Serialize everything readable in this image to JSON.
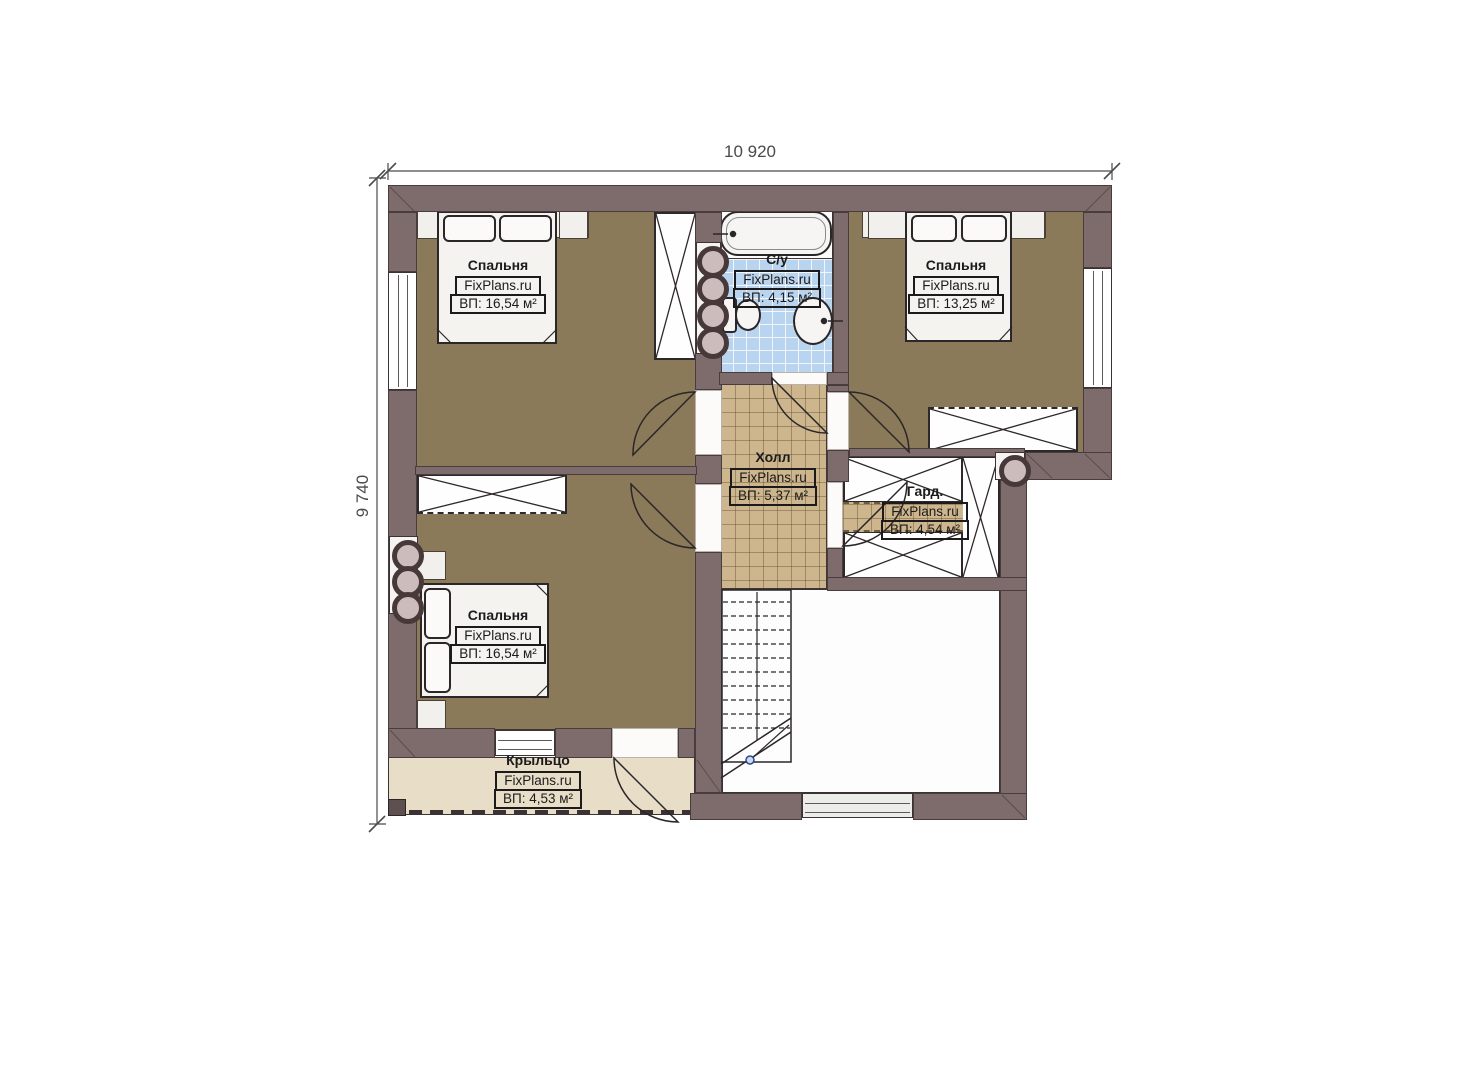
{
  "dimensions": {
    "width": "10 920",
    "height": "9 740"
  },
  "rooms": [
    {
      "key": "bedroom_top_left",
      "name": "Спальня",
      "brand": "FixPlans.ru",
      "area": "ВП: 16,54 м²"
    },
    {
      "key": "bathroom",
      "name": "С/у",
      "brand": "FixPlans.ru",
      "area": "ВП: 4,15 м²"
    },
    {
      "key": "bedroom_top_right",
      "name": "Спальня",
      "brand": "FixPlans.ru",
      "area": "ВП: 13,25 м²"
    },
    {
      "key": "hall",
      "name": "Холл",
      "brand": "FixPlans.ru",
      "area": "ВП: 5,37 м²"
    },
    {
      "key": "wardrobe_room",
      "name": "Гард.",
      "brand": "FixPlans.ru",
      "area": "ВП: 4,54 м²"
    },
    {
      "key": "bedroom_bottom_left",
      "name": "Спальня",
      "brand": "FixPlans.ru",
      "area": "ВП: 16,54 м²"
    },
    {
      "key": "porch",
      "name": "Крыльцо",
      "brand": "FixPlans.ru",
      "area": "ВП: 4,53 м²"
    }
  ],
  "colors": {
    "wall": "#7e6c6c",
    "floor_wood": "#8b7a59",
    "tile_bath": "#b9d4ee",
    "tile_hall": "#cdb68e",
    "porch": "#e8ddc6"
  }
}
